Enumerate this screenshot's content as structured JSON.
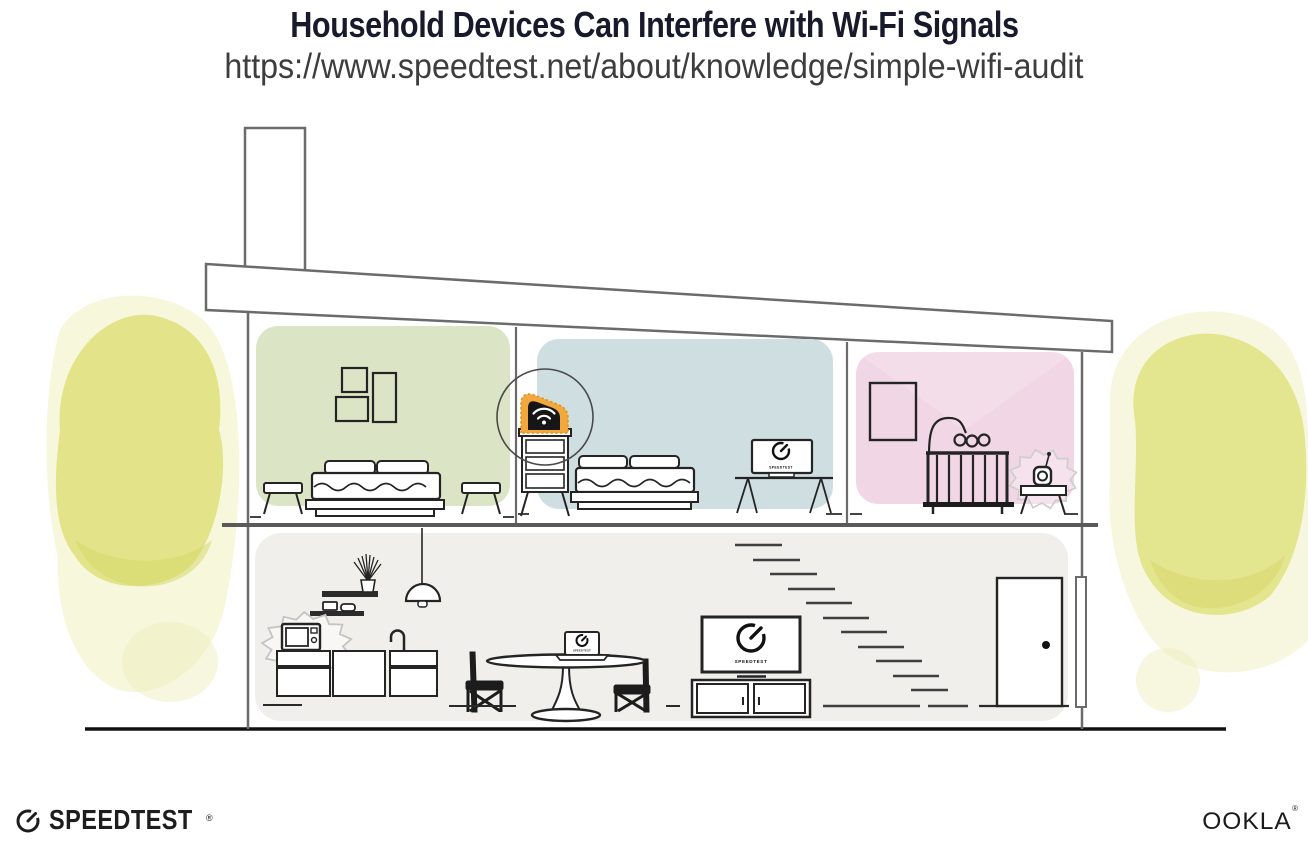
{
  "header": {
    "title": "Household Devices Can Interfere with Wi-Fi Signals",
    "url": "https://www.speedtest.net/about/knowledge/simple-wifi-audit"
  },
  "screens": {
    "brand": "SPEEDTEST"
  },
  "footer": {
    "speedtest_wordmark": "SPEEDTEST",
    "ookla_wordmark": "OOKLA",
    "reg_mark": "®"
  },
  "colors": {
    "title_text": "#181a2c",
    "url_text": "#3d3d3d",
    "structure_outline": "#6b6b6b",
    "furniture_ink": "#242424",
    "room_green": "#dbe5c5",
    "room_blue": "#cfdee1",
    "room_pink": "#f1d6e5",
    "lower_floor_gray": "#f0efec",
    "foliage_yellow": "#dfe07b",
    "foliage_yellow_light": "#eef0bd",
    "router_glow_orange": "#f3a83d",
    "interference_outline": "#c4c4c4",
    "ground_black": "#111111"
  },
  "illustration": {
    "scene": "cutaway-house-two-floors",
    "highlighted_device": "wifi-router",
    "interference_devices": [
      "microwave",
      "baby-monitor"
    ],
    "rooms": [
      {
        "name": "bedroom-left",
        "wall_color": "#dbe5c5",
        "items": [
          "picture-frames",
          "double-bed",
          "side-stools"
        ]
      },
      {
        "name": "bedroom-middle",
        "wall_color": "#cfdee1",
        "items": [
          "wifi-router-on-dresser",
          "double-bed",
          "desk-with-speedtest-monitor"
        ]
      },
      {
        "name": "nursery",
        "wall_color": "#f1d6e5",
        "items": [
          "picture-frame",
          "crib-with-mobile",
          "baby-monitor-on-table"
        ]
      },
      {
        "name": "living-kitchen",
        "wall_color": "#f0efec",
        "items": [
          "pendant-lamp",
          "wall-shelves",
          "microwave",
          "kitchen-cabinets",
          "sink-faucet",
          "dining-table-with-laptop",
          "dining-chairs",
          "tv-with-speedtest-on-console",
          "staircase",
          "entry-door"
        ]
      }
    ],
    "outdoor": [
      "yellow-tree-left",
      "yellow-tree-right",
      "chimney",
      "slanted-roof"
    ]
  }
}
